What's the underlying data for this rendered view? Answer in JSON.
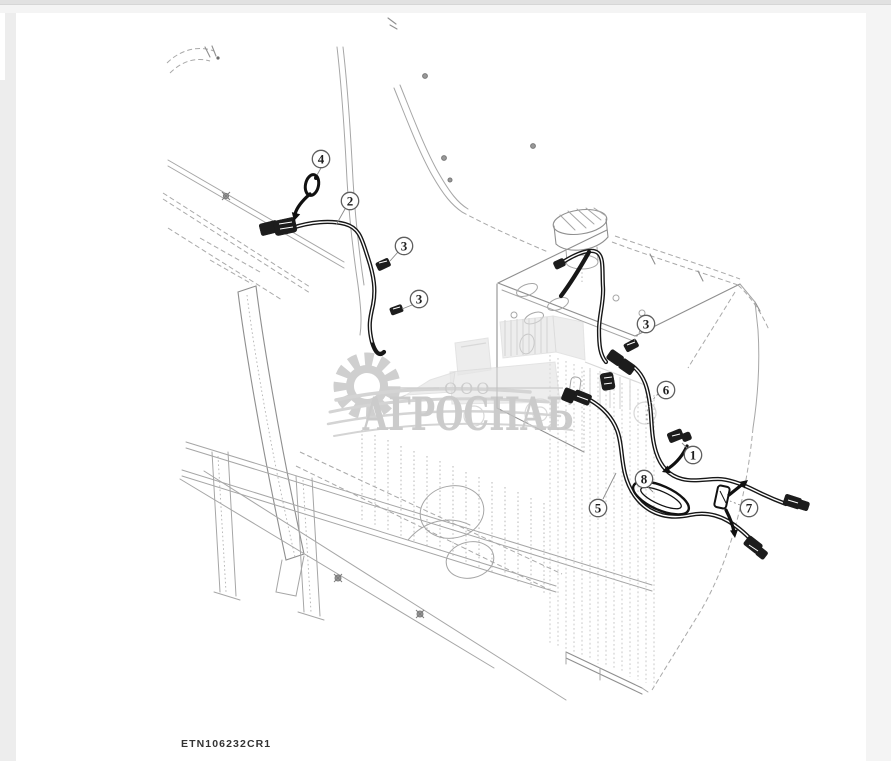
{
  "page": {
    "background": "#ededed",
    "content_background": "#ffffff",
    "top_bar_color": "#e1e1e1",
    "secondary_bar_color": "#f4f4f4",
    "right_strip_color": "#f4f4f4"
  },
  "diagram": {
    "drawing_code": "ETN106232CR1",
    "line_color": "#a6a6a6",
    "harness_color": "#171717",
    "callouts": [
      {
        "label": "4"
      },
      {
        "label": "2"
      },
      {
        "label": "3"
      },
      {
        "label": "3"
      },
      {
        "label": "3"
      },
      {
        "label": "6"
      },
      {
        "label": "1"
      },
      {
        "label": "8"
      },
      {
        "label": "5"
      },
      {
        "label": "7"
      }
    ]
  },
  "watermark": {
    "org_form": "ООО",
    "company_name": "АГРОСНАБ",
    "color": "#c4c4c4"
  }
}
